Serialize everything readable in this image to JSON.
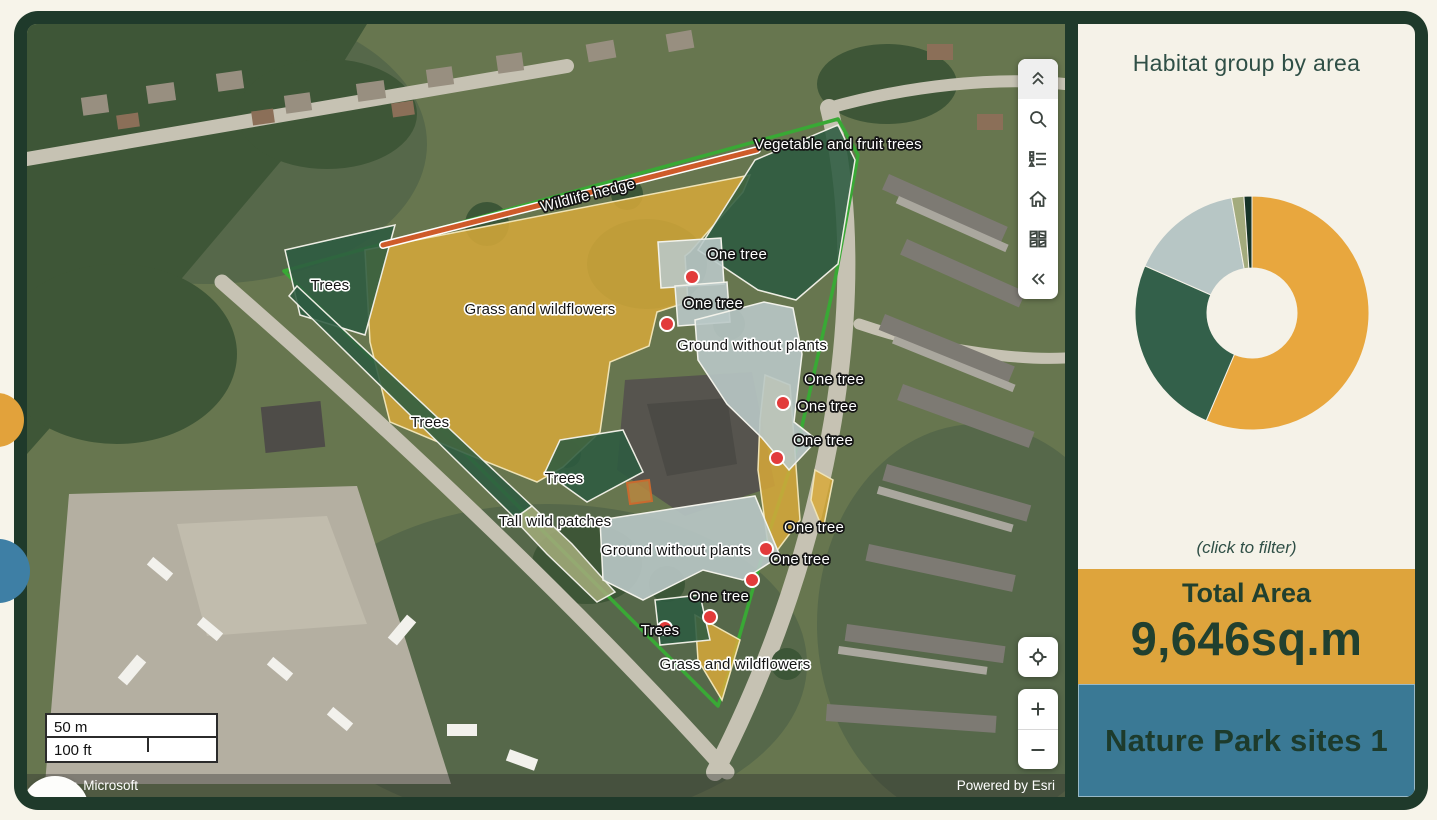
{
  "panel": {
    "title": "Habitat group by area",
    "hint": "(click to filter)",
    "total_label": "Total Area",
    "total_value": "9,646sq.m",
    "footer": "Nature Park sites 1",
    "colors": {
      "background": "#F5F2E8",
      "frame": "#1F3A2B",
      "total_band": "#DEA43C",
      "footer_band": "#3A7995",
      "text": "#21402F"
    }
  },
  "chart_data": {
    "type": "pie",
    "subtype": "donut",
    "title": "Habitat group by area",
    "legend_position": "none",
    "total_label": "Total Area",
    "total_value": "9,646sq.m",
    "unit": "percent of total area (estimated from arc angles)",
    "start_angle_deg": 0,
    "series": [
      {
        "name": "Grass and wildflowers",
        "percent": 56.4,
        "color": "#E8A73E"
      },
      {
        "name": "Trees",
        "percent": 25.2,
        "color": "#33604A"
      },
      {
        "name": "Ground without plants",
        "percent": 15.6,
        "color": "#B7C6C5"
      },
      {
        "name": "Tall wild patches",
        "percent": 1.7,
        "color": "#A3AB7D"
      },
      {
        "name": "Vegetable and fruit trees",
        "percent": 1.1,
        "color": "#173428"
      }
    ]
  },
  "map": {
    "attribution_left": "Maxar, Microsoft",
    "attribution_right": "Powered by Esri",
    "scalebar": {
      "metric": "50 m",
      "imperial": "100 ft"
    },
    "labels": [
      {
        "text": "Vegetable and fruit trees",
        "x": 811,
        "y": 121,
        "style": "point"
      },
      {
        "text": "Wildlife hedge",
        "x": 561,
        "y": 172,
        "style": "point",
        "rot": -14.5
      },
      {
        "text": "Trees",
        "x": 303,
        "y": 262,
        "style": "area"
      },
      {
        "text": "Grass and wildflowers",
        "x": 513,
        "y": 286,
        "style": "area"
      },
      {
        "text": "One tree",
        "x": 710,
        "y": 231,
        "style": "point"
      },
      {
        "text": "One tree",
        "x": 686,
        "y": 280,
        "style": "point"
      },
      {
        "text": "Ground without plants",
        "x": 725,
        "y": 322,
        "style": "area"
      },
      {
        "text": "One tree",
        "x": 807,
        "y": 356,
        "style": "point"
      },
      {
        "text": "One tree",
        "x": 800,
        "y": 383,
        "style": "point"
      },
      {
        "text": "One tree",
        "x": 796,
        "y": 417,
        "style": "point"
      },
      {
        "text": "Trees",
        "x": 403,
        "y": 399,
        "style": "area"
      },
      {
        "text": "Trees",
        "x": 537,
        "y": 455,
        "style": "area"
      },
      {
        "text": "Tall wild patches",
        "x": 528,
        "y": 498,
        "style": "area"
      },
      {
        "text": "One tree",
        "x": 787,
        "y": 504,
        "style": "point"
      },
      {
        "text": "Ground without plants",
        "x": 649,
        "y": 527,
        "style": "area"
      },
      {
        "text": "One tree",
        "x": 773,
        "y": 536,
        "style": "point"
      },
      {
        "text": "One tree",
        "x": 692,
        "y": 573,
        "style": "point"
      },
      {
        "text": "Trees",
        "x": 633,
        "y": 607,
        "style": "point"
      },
      {
        "text": "Grass and wildflowers",
        "x": 708,
        "y": 641,
        "style": "area"
      }
    ],
    "markers": [
      [
        665,
        253
      ],
      [
        640,
        300
      ],
      [
        756,
        379
      ],
      [
        750,
        434
      ],
      [
        739,
        525
      ],
      [
        725,
        556
      ],
      [
        683,
        593
      ],
      [
        638,
        604
      ]
    ]
  }
}
